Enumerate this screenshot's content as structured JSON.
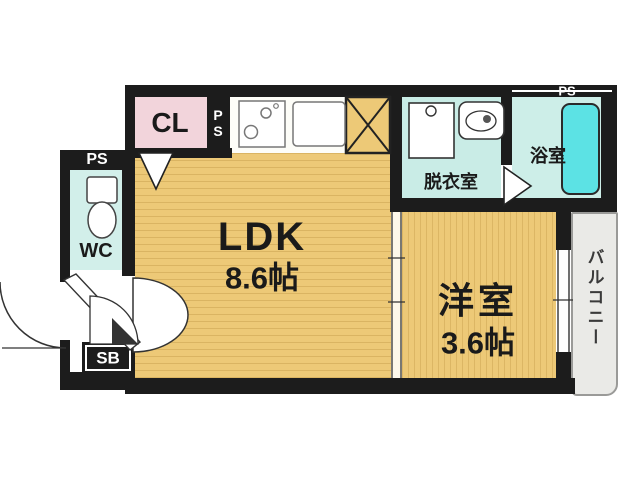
{
  "floorplan": {
    "ldk": {
      "label": "LDK",
      "area": "8.6帖"
    },
    "western_room": {
      "label": "洋室",
      "area": "3.6帖"
    },
    "dressing_room": {
      "label": "脱衣室"
    },
    "bathroom": {
      "label": "浴室"
    },
    "toilet": {
      "label": "WC"
    },
    "closet": {
      "label": "CL"
    },
    "shoe_box": {
      "label": "SB"
    },
    "balcony": {
      "label": "バルコニー"
    },
    "pipe_space": {
      "label": "PS"
    },
    "colors": {
      "wall": "#1c1c1c",
      "floor_tan": "#edc977",
      "closet_pink": "#f2d4db",
      "wet_area_cyan": "#c9ece6",
      "bathtub_cyan": "#5ce2e4",
      "balcony_gray": "#eaeae7"
    },
    "icons": [
      "stove-icon",
      "kitchen-sink-icon",
      "refrigerator-space-icon",
      "washing-machine-icon",
      "washbasin-icon",
      "bathtub-icon",
      "toilet-icon",
      "door-swing-icon",
      "door-arrow-icon"
    ]
  }
}
